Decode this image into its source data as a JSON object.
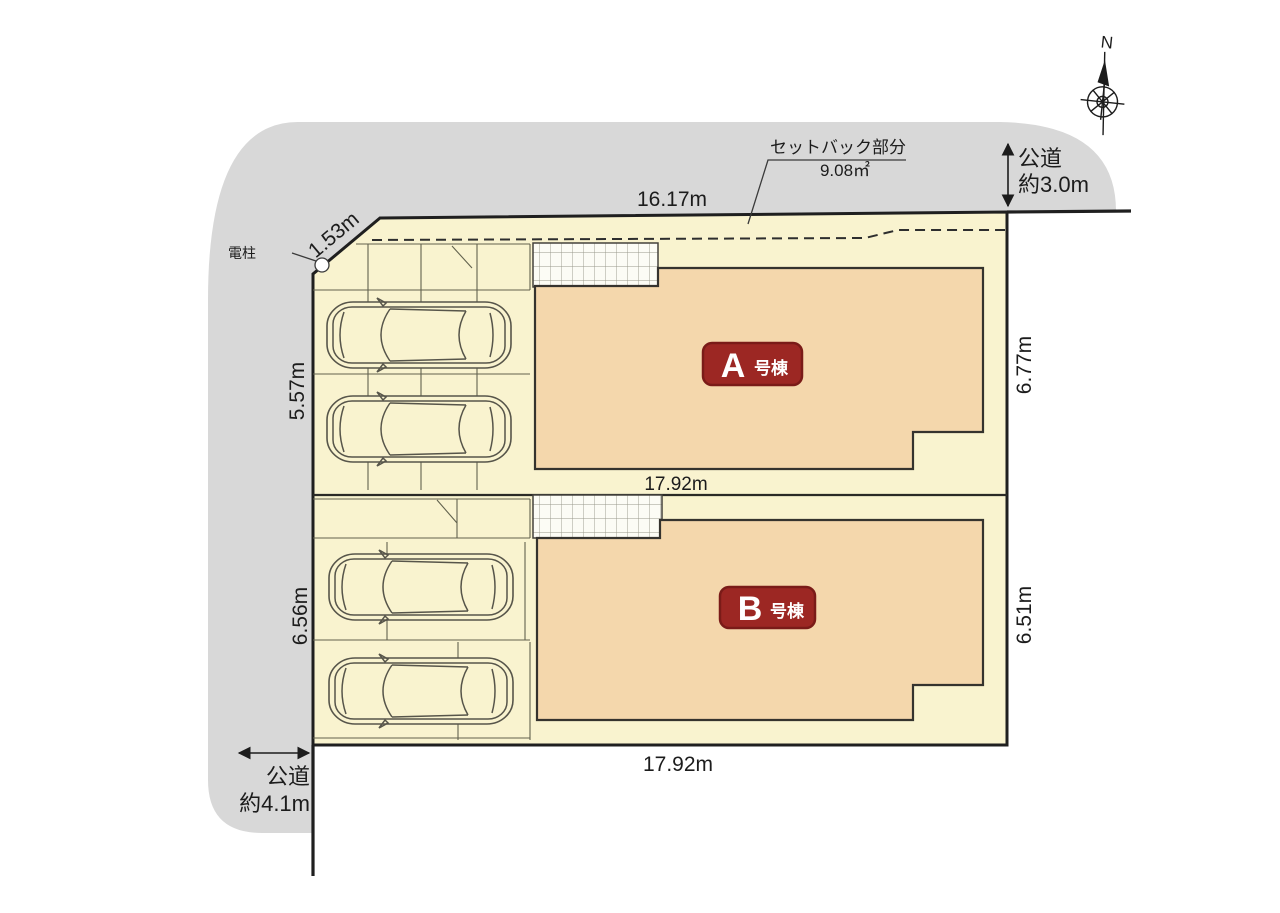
{
  "plan": {
    "compass": {
      "north": "N"
    },
    "setback": {
      "label": "セットバック部分",
      "area": "9.08㎡"
    },
    "roads": {
      "top": {
        "name": "公道",
        "width": "約3.0m"
      },
      "left": {
        "name": "公道",
        "width": "約4.1m"
      }
    },
    "boundary": {
      "top": "16.17m",
      "corner": "1.53m",
      "pole": "電柱"
    },
    "lot_a": {
      "left": "5.57m",
      "right": "6.77m",
      "bottom": "17.92m",
      "badge": {
        "letter": "A",
        "suffix": "号棟"
      }
    },
    "lot_b": {
      "left": "6.56m",
      "right": "6.51m",
      "bottom": "17.92m",
      "badge": {
        "letter": "B",
        "suffix": "号棟"
      }
    },
    "colors": {
      "road_gray": "#d8d8d8",
      "plot_cream": "#f9f3cf",
      "building_tan": "#f4d7ac",
      "badge_red": "#9c2723"
    }
  }
}
